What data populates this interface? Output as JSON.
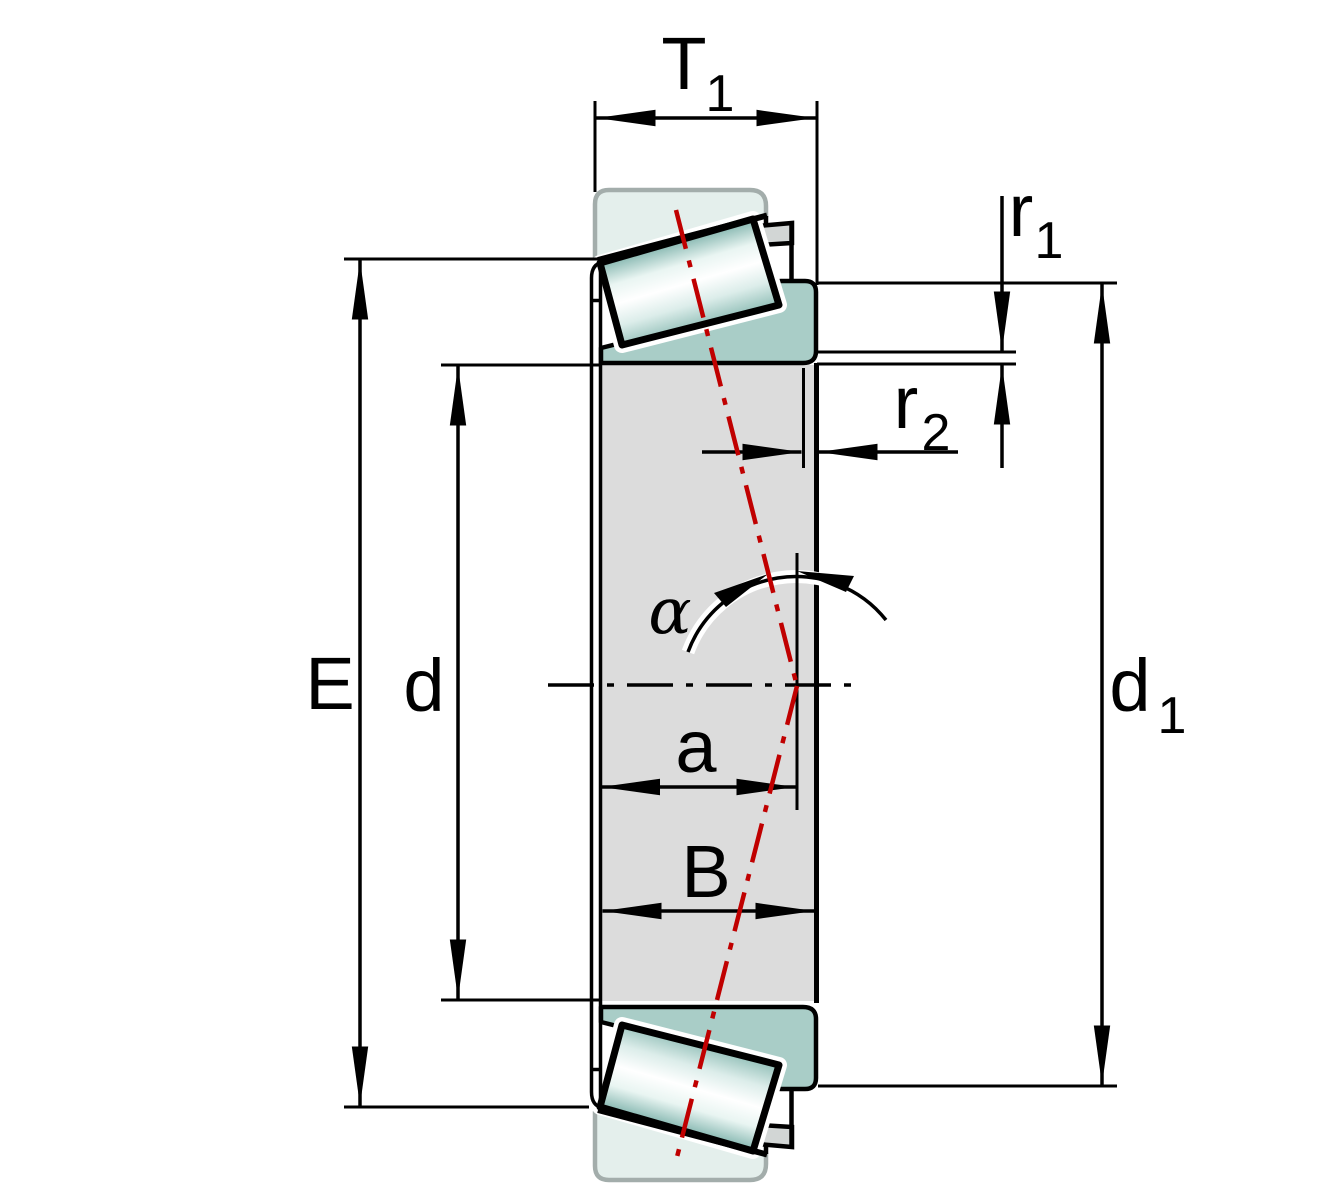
{
  "labels": {
    "t1": {
      "base": "T",
      "sub": "1"
    },
    "r1": {
      "base": "r",
      "sub": "1"
    },
    "r2": {
      "base": "r",
      "sub": "2"
    },
    "E": "E",
    "d": "d",
    "d1": {
      "base": "d",
      "sub": "1"
    },
    "a": "a",
    "B": "B",
    "alpha": "α"
  },
  "colors": {
    "outer_ring_fill": "#e4efec",
    "inner_ring_fill": "#a9cdc7",
    "bore_fill": "#dcdcdc",
    "cage_fill": "#d2d6d5",
    "roller_edge_teal": "#7fb3ac",
    "axis_red": "#c00000",
    "outline_black": "#000000",
    "ring_edge_gray": "#a3adab"
  }
}
